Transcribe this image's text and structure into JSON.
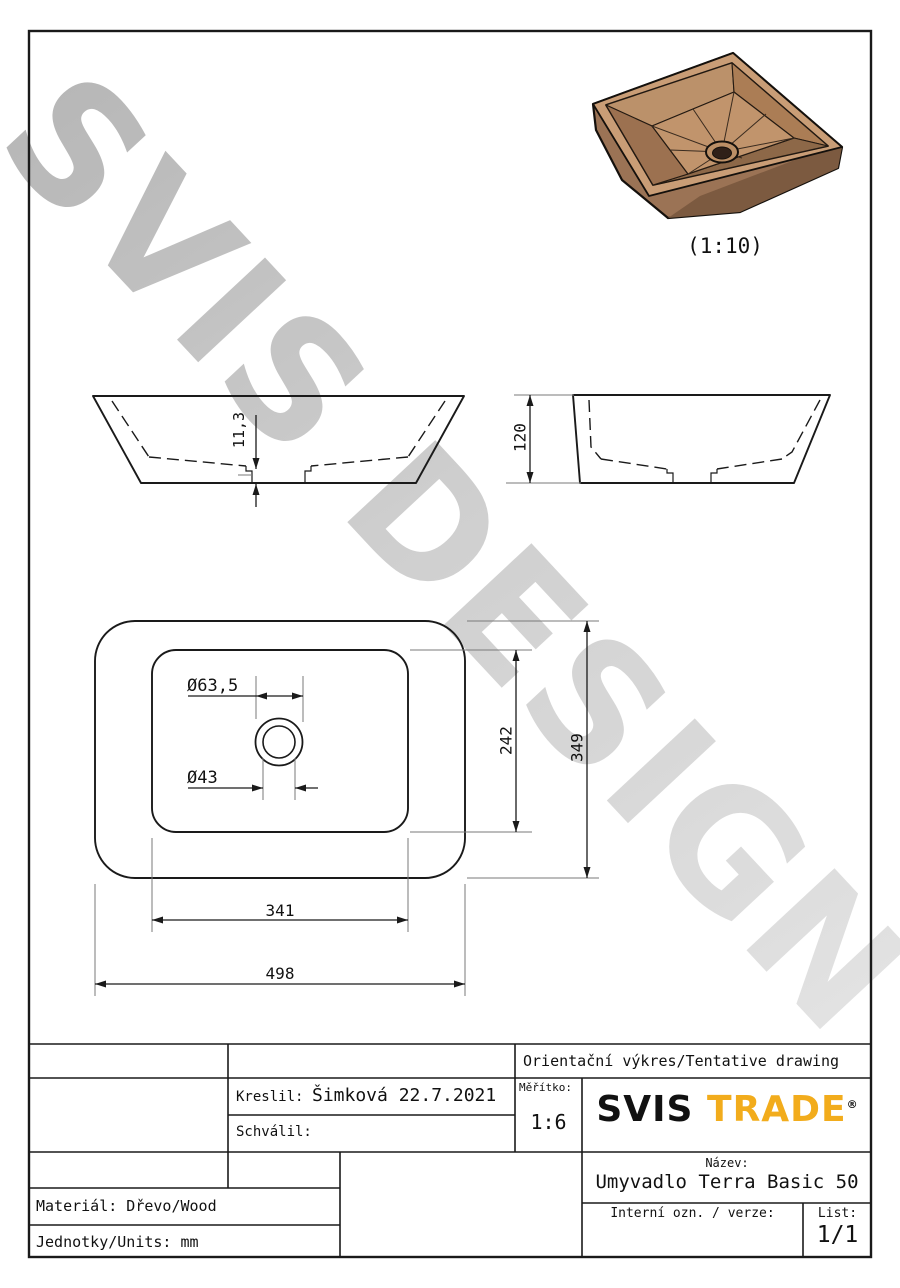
{
  "watermark": {
    "text": "SVIS DESIGN"
  },
  "render": {
    "scale_caption": "(1:10)"
  },
  "dims": {
    "drain_boss_height": "11,3",
    "overall_height": "120",
    "drain_outer_dia": "Ø63,5",
    "drain_inner_dia": "Ø43",
    "basin_depth": "242",
    "overall_depth": "349",
    "basin_width": "341",
    "overall_width": "498"
  },
  "title_block": {
    "tentative": "Orientační výkres/Tentative drawing",
    "drawn_label": "Kreslil:",
    "drawn_value": "Šimková 22.7.2021",
    "approved_label": "Schválil:",
    "scale_label": "Měřítko:",
    "scale_value": "1:6",
    "logo_svis": "SVIS",
    "logo_trade": "TRADE",
    "logo_reg": "®",
    "name_label": "Název:",
    "name_value": "Umyvadlo Terra Basic 50",
    "material": "Materiál: Dřevo/Wood",
    "units": "Jednotky/Units: mm",
    "internal_label": "Interní ozn. / verze:",
    "sheet_label": "List:",
    "sheet_value": "1/1"
  },
  "colors": {
    "line": "#1a1a1a",
    "extension_line": "#7a7a7a",
    "logo_orange": "#F2AC1C",
    "watermark_gray": "#c6c6c6",
    "wood_rim": "#c99d76",
    "wood_wall_dark": "#8d6848",
    "wood_floor": "#c1946c",
    "drain_hole": "#2f2018"
  }
}
